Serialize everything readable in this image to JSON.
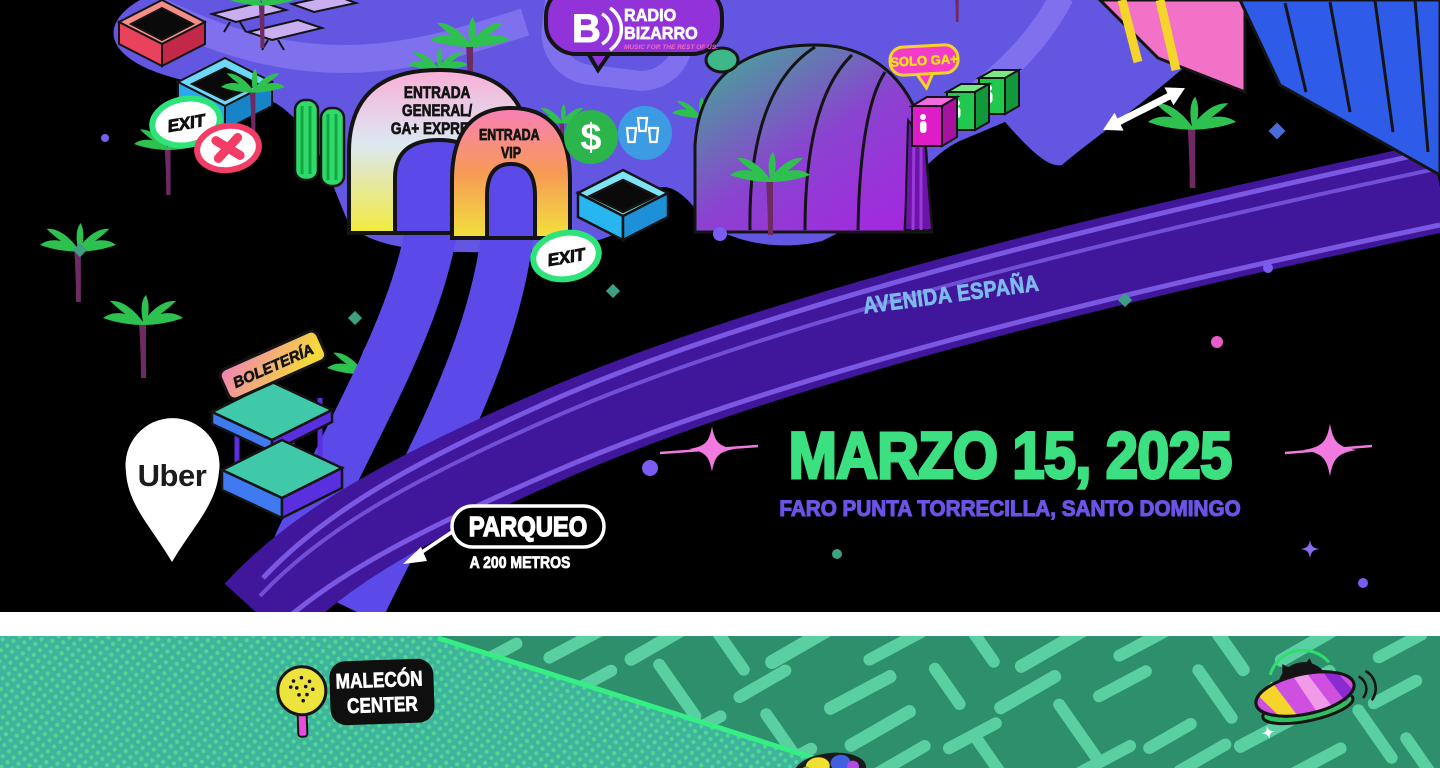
{
  "brand": {
    "logo_letter": "B",
    "name_lines": [
      "RADIO",
      "BIZARRO"
    ],
    "tagline": "MUSIC FOR THE REST OF US."
  },
  "event": {
    "date": "MARZO 15, 2025",
    "venue": "FARO PUNTA TORRECILLA, SANTO DOMINGO"
  },
  "map_labels": {
    "entrance_general_lines": [
      "ENTRADA",
      "GENERAL/",
      "GA+ EXPRESS"
    ],
    "entrance_vip_lines": [
      "ENTRADA",
      "VIP"
    ],
    "exit": "EXIT",
    "solo_ga_plus": "SOLO GA+",
    "boleteria": "BOLETERÍA",
    "uber": "Uber",
    "parqueo": "PARQUEO",
    "parqueo_distance": "A 200 METROS",
    "avenida": "AVENIDA ESPAÑA",
    "malecon_lines": [
      "MALECÓN",
      "CENTER"
    ],
    "atm_symbol": "$"
  },
  "colors": {
    "ground_purple": "#6357e2",
    "light_path_purple": "#8273ee",
    "road_purple": "#40179b",
    "road_stripe": "#7e5ce6",
    "path_indigo": "#5b49e8",
    "date_green": "#3ce080",
    "venue_purple": "#6b53e8",
    "avenue_blue": "#7db9ea",
    "exit_green": "#2ee37a",
    "closed_red": "#f23d66",
    "bubble_purple": "#9233d9",
    "tagline_pink": "#f06ac0",
    "solo_pink": "#f23cc8",
    "solo_yellow": "#f8e11c",
    "map_green_dark": "#2e8f6c",
    "map_green_light": "#5ad0a2",
    "sea_teal": "#3eb49c",
    "sea_border_green": "#35ef85"
  }
}
